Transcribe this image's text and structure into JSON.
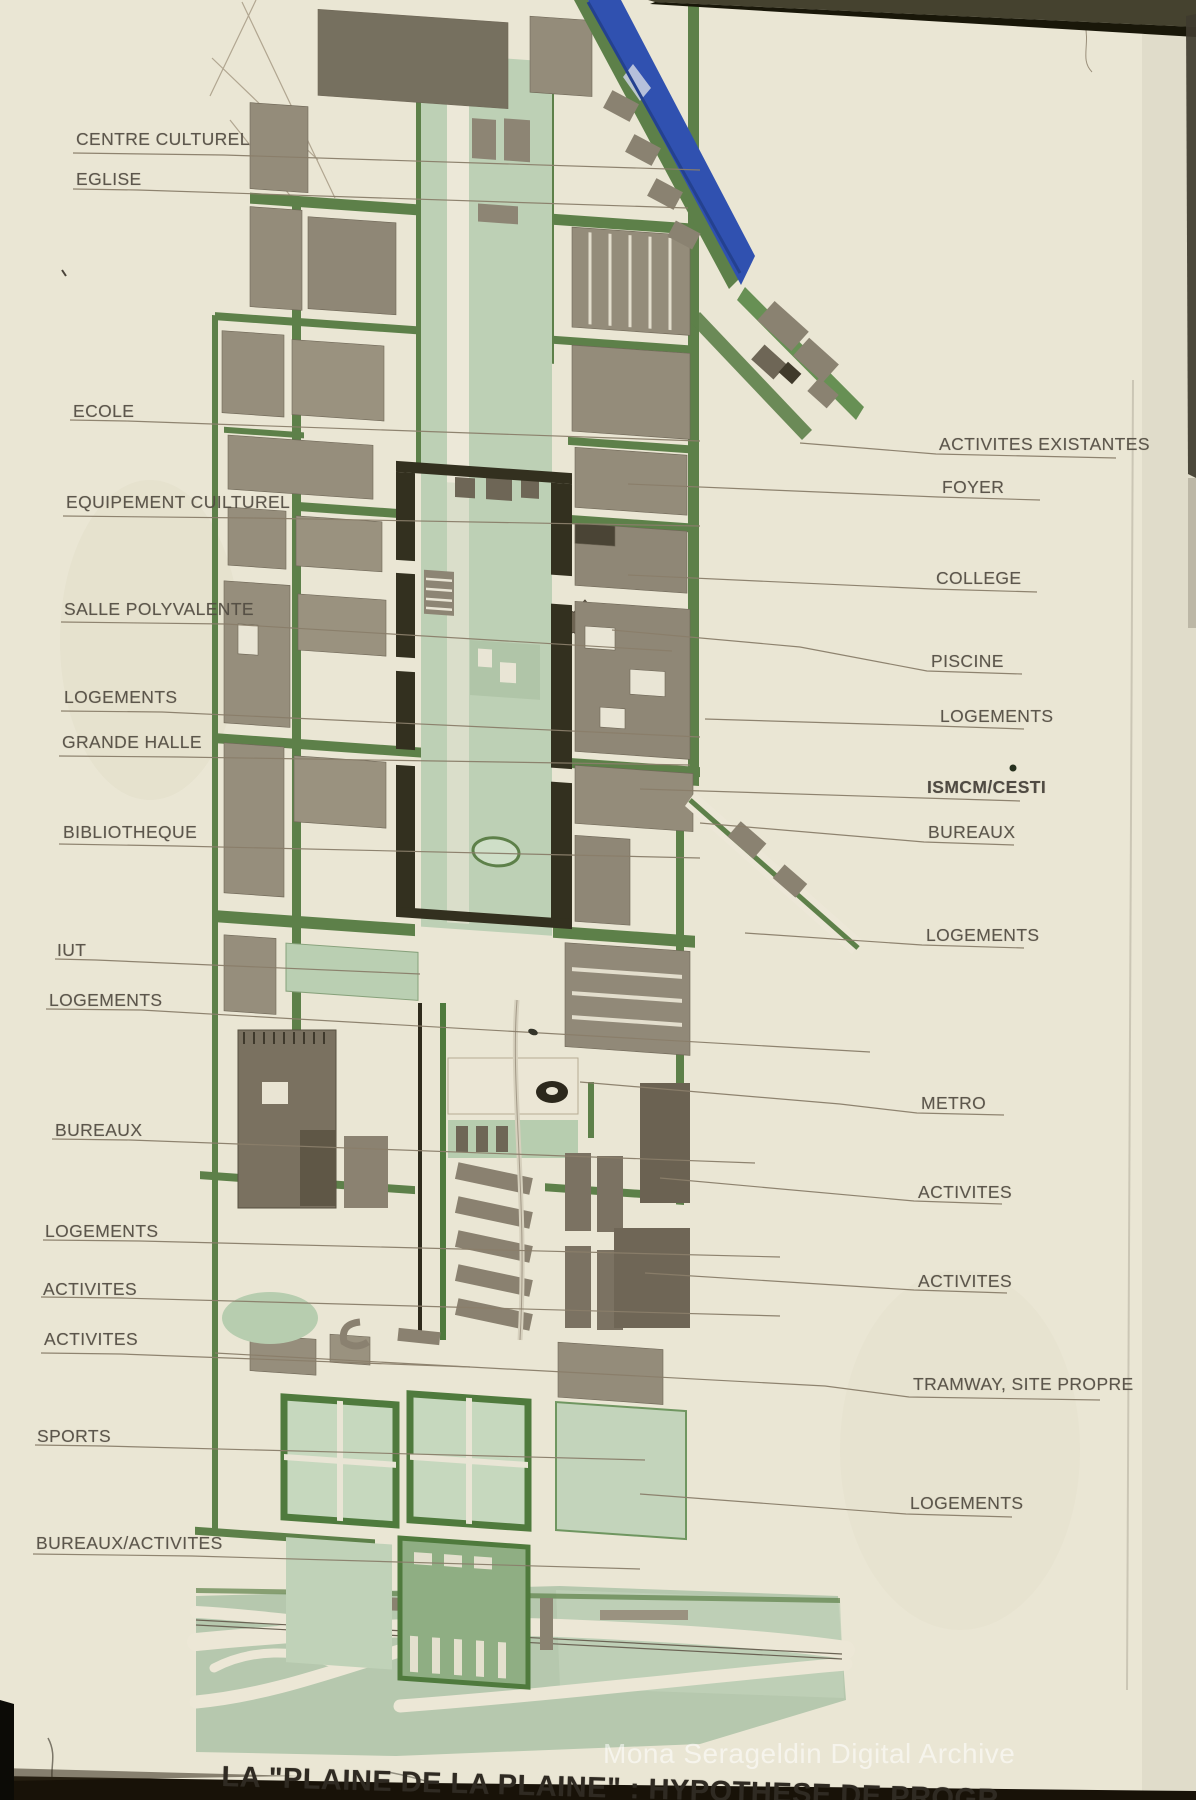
{
  "slide": {
    "title": "LA \"PLAINE DE LA PLAINE\" : HYPOTHESE DE PROGR",
    "watermark": "Mona Serageldin Digital Archive",
    "labels_left": [
      "CENTRE CULTUREL",
      "EGLISE",
      "ECOLE",
      "EQUIPEMENT CUILTUREL",
      "SALLE POLYVALENTE",
      "LOGEMENTS",
      "GRANDE HALLE",
      "BIBLIOTHEQUE",
      "IUT",
      "LOGEMENTS",
      "BUREAUX",
      "LOGEMENTS",
      "ACTIVITES",
      "ACTIVITES",
      "SPORTS",
      "BUREAUX/ACTIVITES"
    ],
    "labels_right": [
      "ACTIVITES EXISTANTES",
      "FOYER",
      "COLLEGE",
      "PISCINE",
      "LOGEMENTS",
      "ISMCM/CESTI",
      "BUREAUX",
      "LOGEMENTS",
      "METRO",
      "ACTIVITES",
      "ACTIVITES",
      "TRAMWAY, SITE PROPRE",
      "LOGEMENTS"
    ],
    "colors": {
      "paper": "#eae6d4",
      "street_green": "#5d8049",
      "corridor_green": "#bdd0b5",
      "building_gray": "#958d7b",
      "dark_block": "#33301f",
      "river_blue": "#3051b0",
      "label_text": "#524c42"
    }
  }
}
